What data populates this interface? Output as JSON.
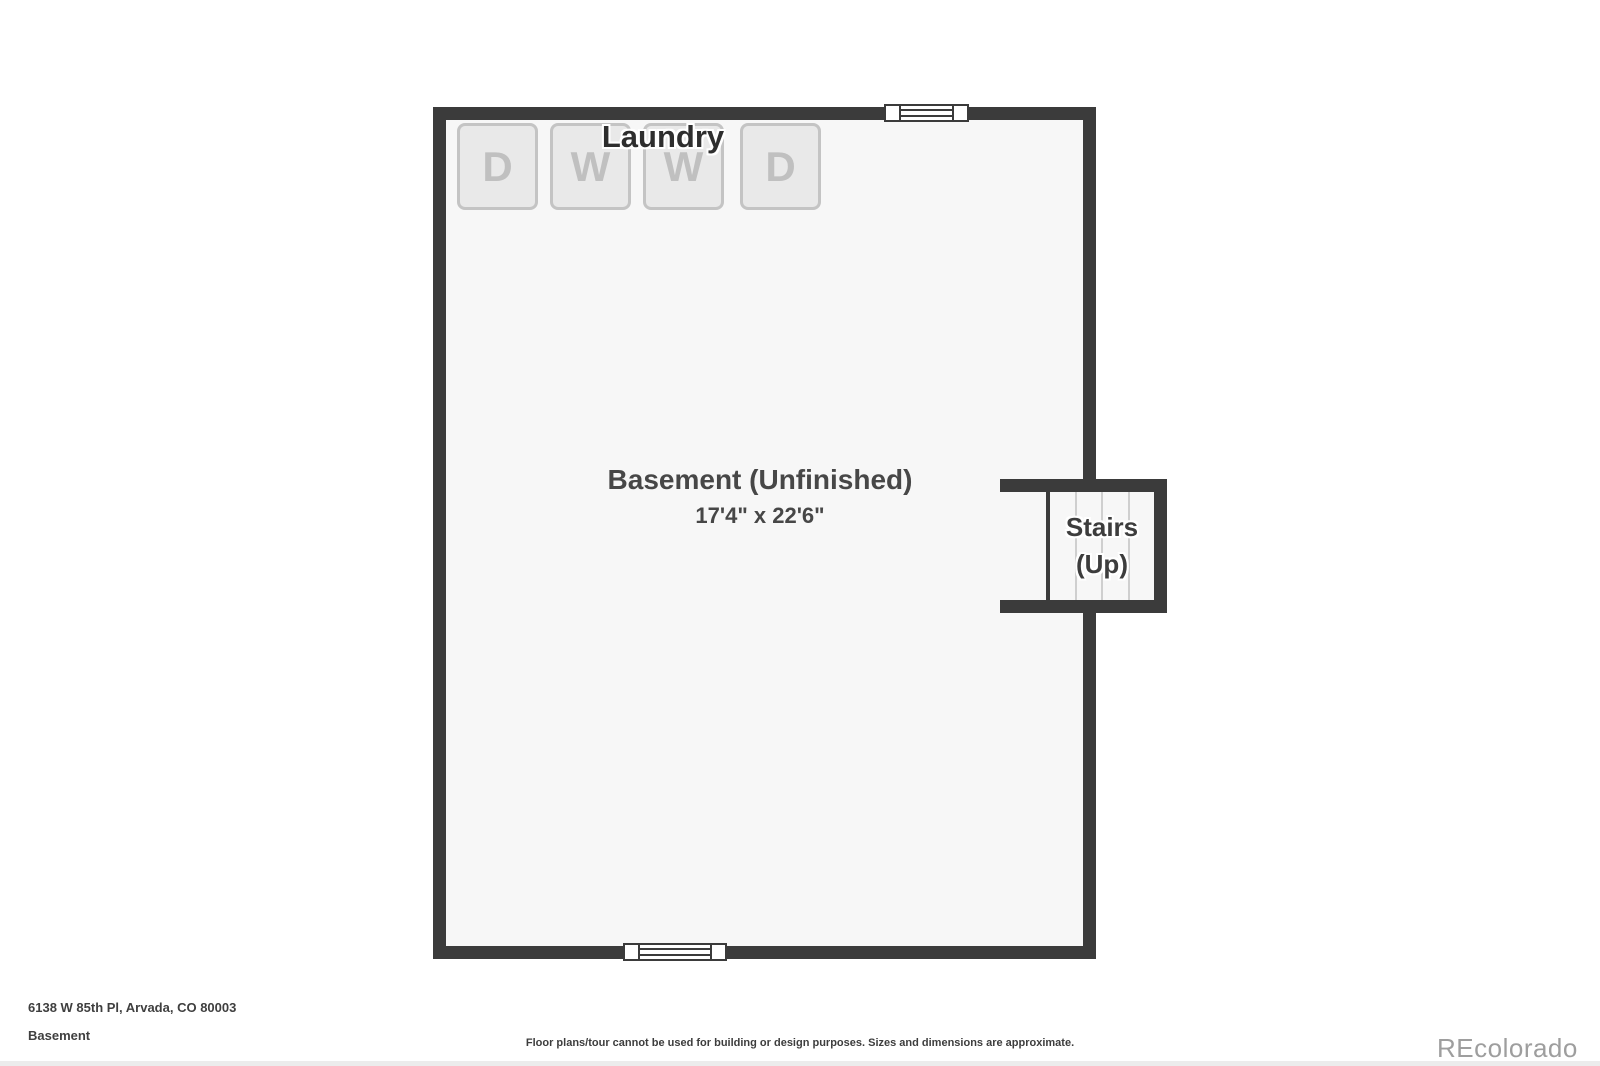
{
  "floorplan": {
    "laundry_label": "Laundry",
    "appliances": [
      "D",
      "W",
      "W",
      "D"
    ],
    "room_name": "Basement (Unfinished)",
    "room_dimensions": "17'4\" x 22'6\"",
    "stairs_line1": "Stairs",
    "stairs_line2": "(Up)"
  },
  "footer": {
    "address": "6138 W 85th Pl, Arvada, CO 80003",
    "floor_label": "Basement",
    "disclaimer": "Floor plans/tour cannot be used for building or design purposes. Sizes and dimensions are approximate.",
    "watermark": "REcolorado"
  },
  "colors": {
    "wall": "#3b3b3b",
    "floor": "#f7f7f7",
    "appliance_fill": "#e9e9e9",
    "appliance_border": "#c4c4c4",
    "appliance_letter": "#c0c0c0",
    "laundry_text": "#2e2e2e",
    "room_text": "#474747",
    "stairs_text": "#3d3d3d",
    "footer_text": "#3f3f3f",
    "watermark_gray": "#9e9e9e",
    "tread_line": "#cfcfcf",
    "bottom_strip": "#ececec"
  }
}
